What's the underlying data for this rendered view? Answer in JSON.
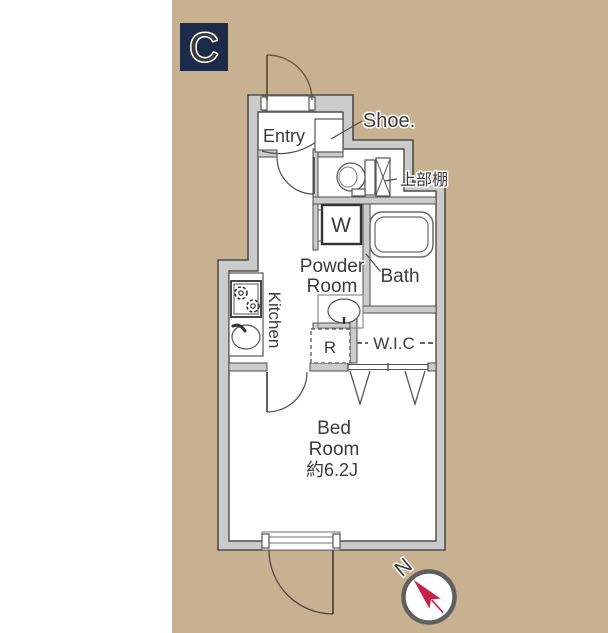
{
  "plan": {
    "unit_label": "C",
    "labels": {
      "entry": "Entry",
      "shoe": "Shoe.",
      "upper_shelf": "上部棚",
      "washer": "W",
      "powder_line1": "Powder",
      "powder_line2": "Room",
      "bath": "Bath",
      "kitchen": "Kitchen",
      "fridge": "R",
      "wic": "W.I.C",
      "bed_line1": "Bed",
      "bed_line2": "Room",
      "bed_size": "約6.2J"
    },
    "compass": {
      "north": "N"
    },
    "colors": {
      "page_background": "#ffffff",
      "mat_tan": "#c8b190",
      "unit_box_navy": "#1d2b48",
      "wall_fill": "#cbcbcb",
      "wall_stroke": "#4c4c4c",
      "label_text": "#3c3c3c",
      "entry_door_brown": "#6b5a3e",
      "compass_red": "#c5234a"
    }
  }
}
